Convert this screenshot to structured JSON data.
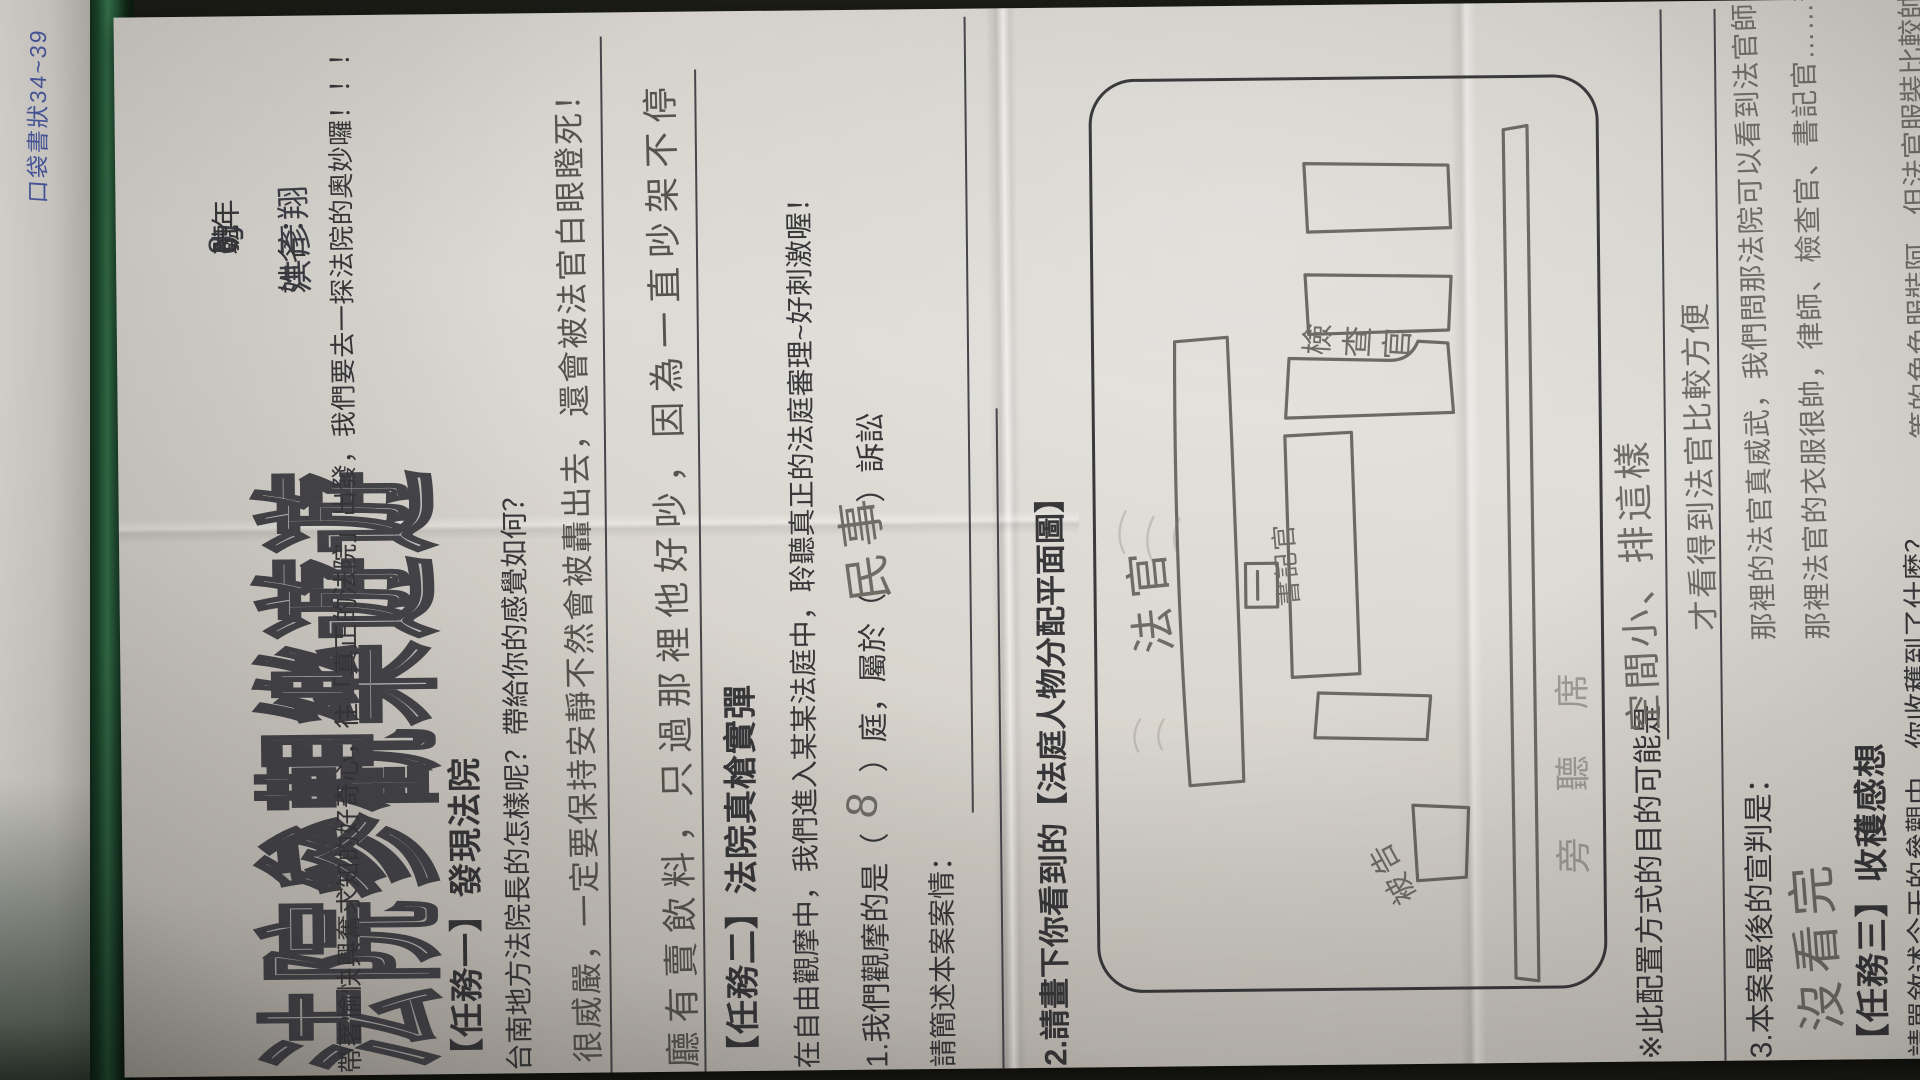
{
  "side": {
    "blue_note": "口袋書狀34~39"
  },
  "header": {
    "title": "法院參觀樂遊遊",
    "grade_prefix": "6 年",
    "class_handwritten": "ㄅ",
    "class_label": "班",
    "seat_handwritten": "8",
    "seat_label": "號",
    "name_label": "姓名：",
    "name_handwritten": "洪彥翔"
  },
  "intro": "帶著愉快興奮求知的好奇心，往「真正的法院」出發，我們要去一探法院的奧妙囉！！！",
  "task1": {
    "heading": "【任務一】發現法院",
    "question": "台南地方法院長的怎樣呢？帶給你的感覺如何？",
    "answer_line1": "很威嚴，一定要保持安靜不然會被轟出去，還會被法官白眼瞪死！",
    "answer_line2": "廳有賣飲料，只過那裡他好吵，因為一直吵架不停"
  },
  "task2": {
    "heading": "【任務二】法院真槍實彈",
    "description": "在自由觀摩中，我們進入某某法庭中，聆聽真正的法庭審理~好刺激喔！",
    "q1_printed": "1.我們觀摩的是（　　）庭，屬於（　　　）訴訟",
    "q1_court_handwritten": "8",
    "q1_type_handwritten": "民事",
    "case_label": "請簡述本案案情：",
    "q2_heading": "2.請畫下你看到的【法庭人物分配平面圖】",
    "diagram": {
      "judge": "法官",
      "clerk": "書記官",
      "prosecutor": "檢查官",
      "defendant": "被告",
      "audience": "旁聽席"
    },
    "note_printed": "※此配置方式的目的可能是",
    "note_handwritten": "空間小、排這樣",
    "note_handwritten_line2": "才看得到法官比較方便",
    "q3_printed": "3.本案最後的宣判是：",
    "q3_answer_handwritten": "沒看完"
  },
  "task3": {
    "heading": "【任務三】收穫感想",
    "question": "請單敘述今天的參觀中，你收穫到了什麼？",
    "essay_line1": "那裡的法官真威武，我們問那法院可以看到法官師",
    "essay_line2": "那裡法官的衣服很帥，律師、檢查官、書記官……等",
    "essay_line3": "等的角色服裝阿，但法官服裝比較帥",
    "essay_line4": "那法院很大但可評真好玩，我覺得法院裡的人物好棒"
  }
}
